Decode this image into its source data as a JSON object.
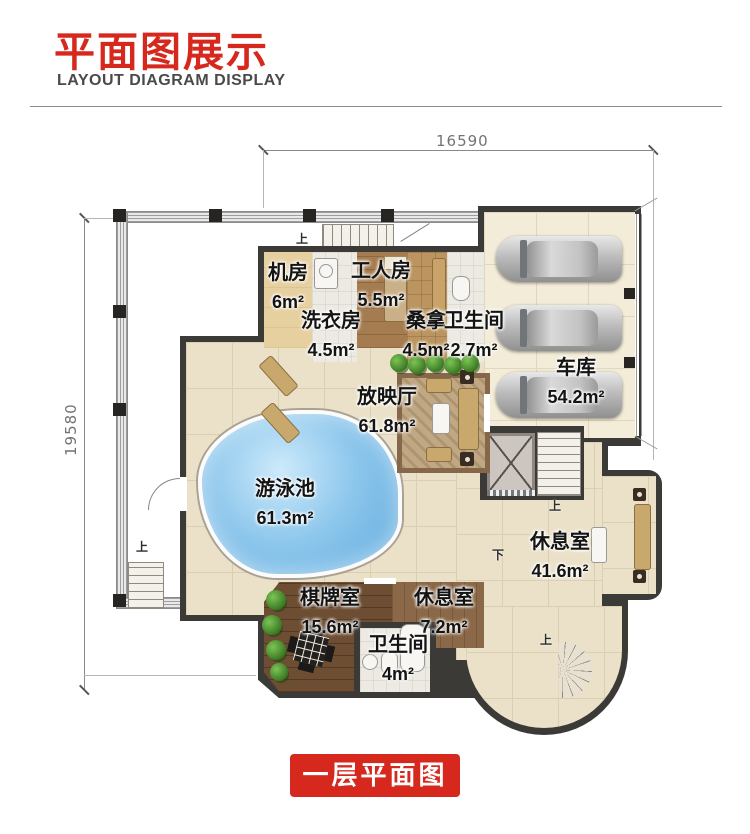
{
  "header": {
    "title": "平面图展示",
    "subtitle": "LAYOUT DIAGRAM DISPLAY"
  },
  "dimensions": {
    "top": "16590",
    "left": "19580"
  },
  "rooms": {
    "jifang": {
      "name": "机房",
      "area": "6m²"
    },
    "xiyifang": {
      "name": "洗衣房",
      "area": "4.5m²"
    },
    "gongrenfang": {
      "name": "工人房",
      "area": "5.5m²"
    },
    "sangna": {
      "name": "桑拿",
      "area": "4.5m²"
    },
    "weishengjian_top": {
      "name": "卫生间",
      "area": "2.7m²"
    },
    "cheku": {
      "name": "车库",
      "area": "54.2m²"
    },
    "fangyingting": {
      "name": "放映厅",
      "area": "61.8m²"
    },
    "youyongchi": {
      "name": "游泳池",
      "area": "61.3m²"
    },
    "xiuxishi_da": {
      "name": "休息室",
      "area": "41.6m²"
    },
    "qipaishi": {
      "name": "棋牌室",
      "area": "15.6m²"
    },
    "xiuxishi_xiao": {
      "name": "休息室",
      "area": "7.2m²"
    },
    "weishengjian_xia": {
      "name": "卫生间",
      "area": "4m²"
    }
  },
  "marks": {
    "up": "上",
    "down": "下"
  },
  "banner": {
    "label": "一层平面图"
  },
  "colors": {
    "accent_red": "#d7281e",
    "wall_dark": "#3b3a37",
    "pool_blue": "#5ea9dc",
    "floor_beige": "#eae1c8",
    "wood_brown": "#a57c50",
    "dim_gray": "#737373"
  }
}
